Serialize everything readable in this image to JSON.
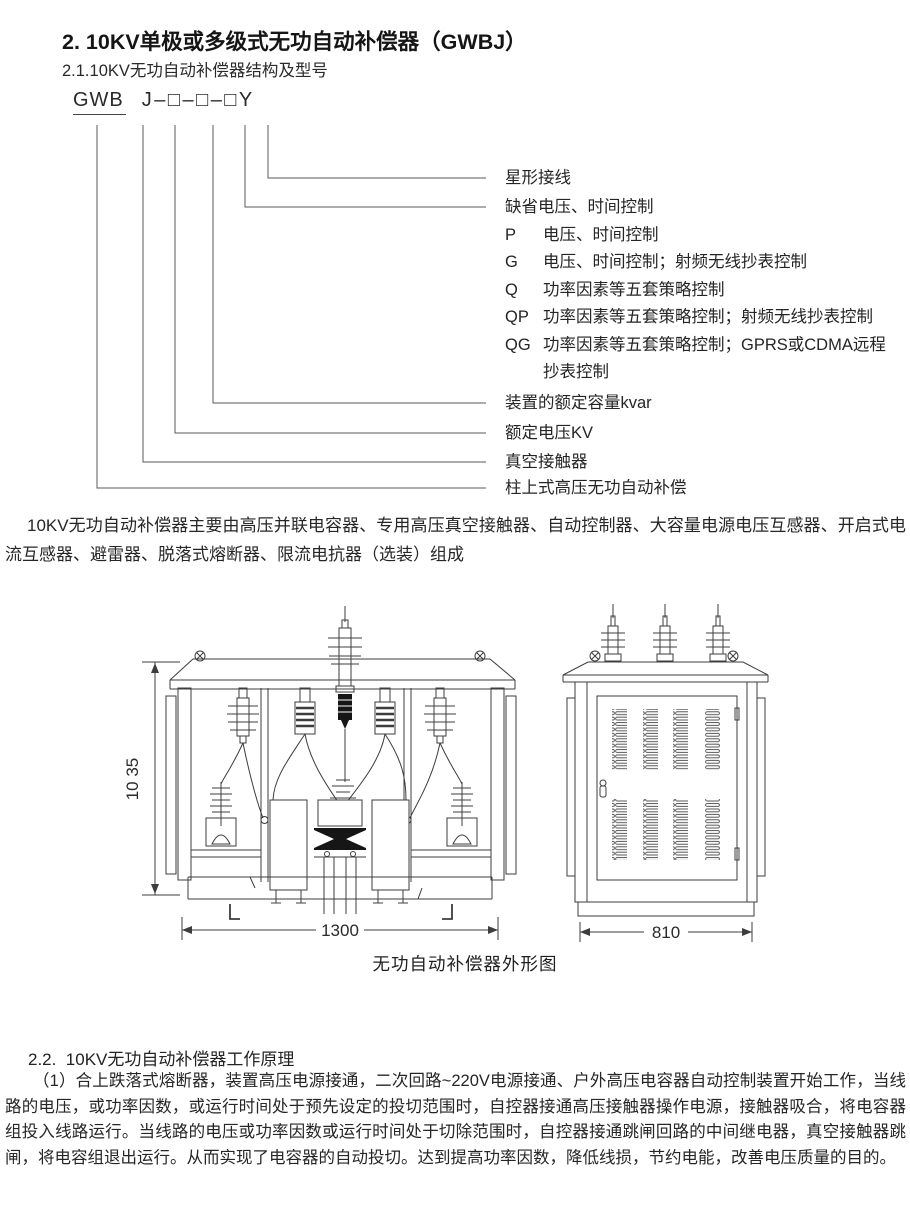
{
  "page": {
    "section_title": "2. 10KV单极或多级式无功自动补偿器（GWBJ）",
    "subsection_title": "2.1.10KV无功自动补偿器结构及型号"
  },
  "model": {
    "prefix": "GWB",
    "suffix": "J–□–□–□Y"
  },
  "code_labels": [
    {
      "letter": "",
      "text": "星形接线"
    },
    {
      "letter": "",
      "text": "缺省电压、时间控制"
    },
    {
      "letter": "P",
      "text": "电压、时间控制"
    },
    {
      "letter": "G",
      "text": "电压、时间控制；射频无线抄表控制"
    },
    {
      "letter": "Q",
      "text": "功率因素等五套策略控制"
    },
    {
      "letter": "QP",
      "text": "功率因素等五套策略控制；射频无线抄表控制"
    },
    {
      "letter": "QG",
      "text": "功率因素等五套策略控制；GPRS或CDMA远程"
    },
    {
      "letter": "",
      "text": "抄表控制"
    },
    {
      "letter": "",
      "text": "装置的额定容量kvar"
    },
    {
      "letter": "",
      "text": "额定电压KV"
    },
    {
      "letter": "",
      "text": "真空接触器"
    },
    {
      "letter": "",
      "text": "柱上式高压无功自动补偿"
    }
  ],
  "composition": "10KV无功自动补偿器主要由高压并联电容器、专用高压真空接触器、自动控制器、大容量电源电压互感器、开启式电流互感器、避雷器、脱落式熔断器、限流电抗器（选装）组成",
  "figure": {
    "front_height_dim": "10 35",
    "front_width_dim": "1300",
    "side_width_dim": "810",
    "caption": "无功自动补偿器外形图"
  },
  "working_principle": {
    "heading": "2.2.  10KV无功自动补偿器工作原理",
    "body": "（1）合上跌落式熔断器，装置高压电源接通，二次回路~220V电源接通、户外高压电容器自动控制装置开始工作，当线路的电压，或功率因数，或运行时间处于预先设定的投切范围时，自控器接通高压接触器操作电源，接触器吸合，将电容器组投入线路运行。当线路的电压或功率因数或运行时间处于切除范围时，自控器接通跳闸回路的中间继电器，真空接触器跳闸，将电容组退出运行。从而实现了电容器的自动投切。达到提高功率因数，降低线损，节约电能，改善电压质量的目的。"
  }
}
